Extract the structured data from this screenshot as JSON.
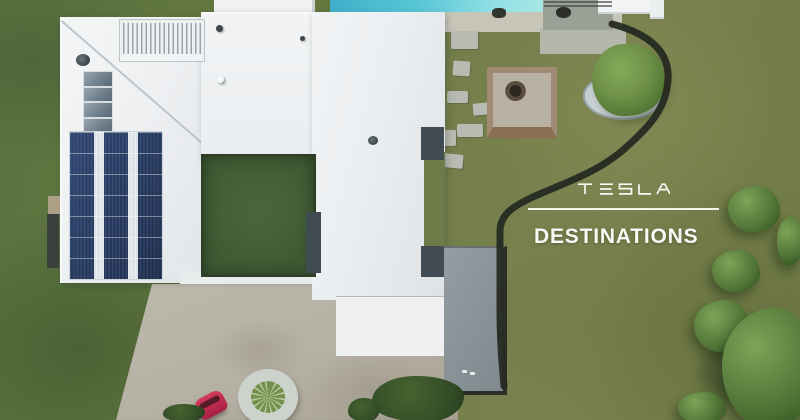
{
  "overlay": {
    "brand": "TESLA",
    "title": "DESTINATIONS"
  },
  "palette": {
    "lawn_left": "#5b7441",
    "lawn_right": "#7b824f",
    "lawn_notch": "#6d7b49",
    "courtyard_grass": "#3f5a33",
    "roof_white": "#eef0f2",
    "roof_shade": "#e2e6e9",
    "solar_navy": "#22314f",
    "skylight_gray": "#6f7e8b",
    "pool_water": "#8edfe4",
    "pool_deck": "#9aa096",
    "sand_strip": "#d2cfc2",
    "concrete_apron": "#c6c5b8",
    "stepping_stone": "#b7bbb1",
    "firepit_paver": "#a08a74",
    "firepit_inner": "#b9b1a3",
    "treebed_pebble": "#ccd3d6",
    "edging_dark": "#262a22",
    "driveway_gravel": "#b5b1a4",
    "patio_concrete": "#879196",
    "tree_light": "#7da457",
    "tree_mid": "#55793a",
    "tree_dark": "#3a5b27",
    "car_red": "#a91f44",
    "text_white": "#f8f8f4"
  }
}
